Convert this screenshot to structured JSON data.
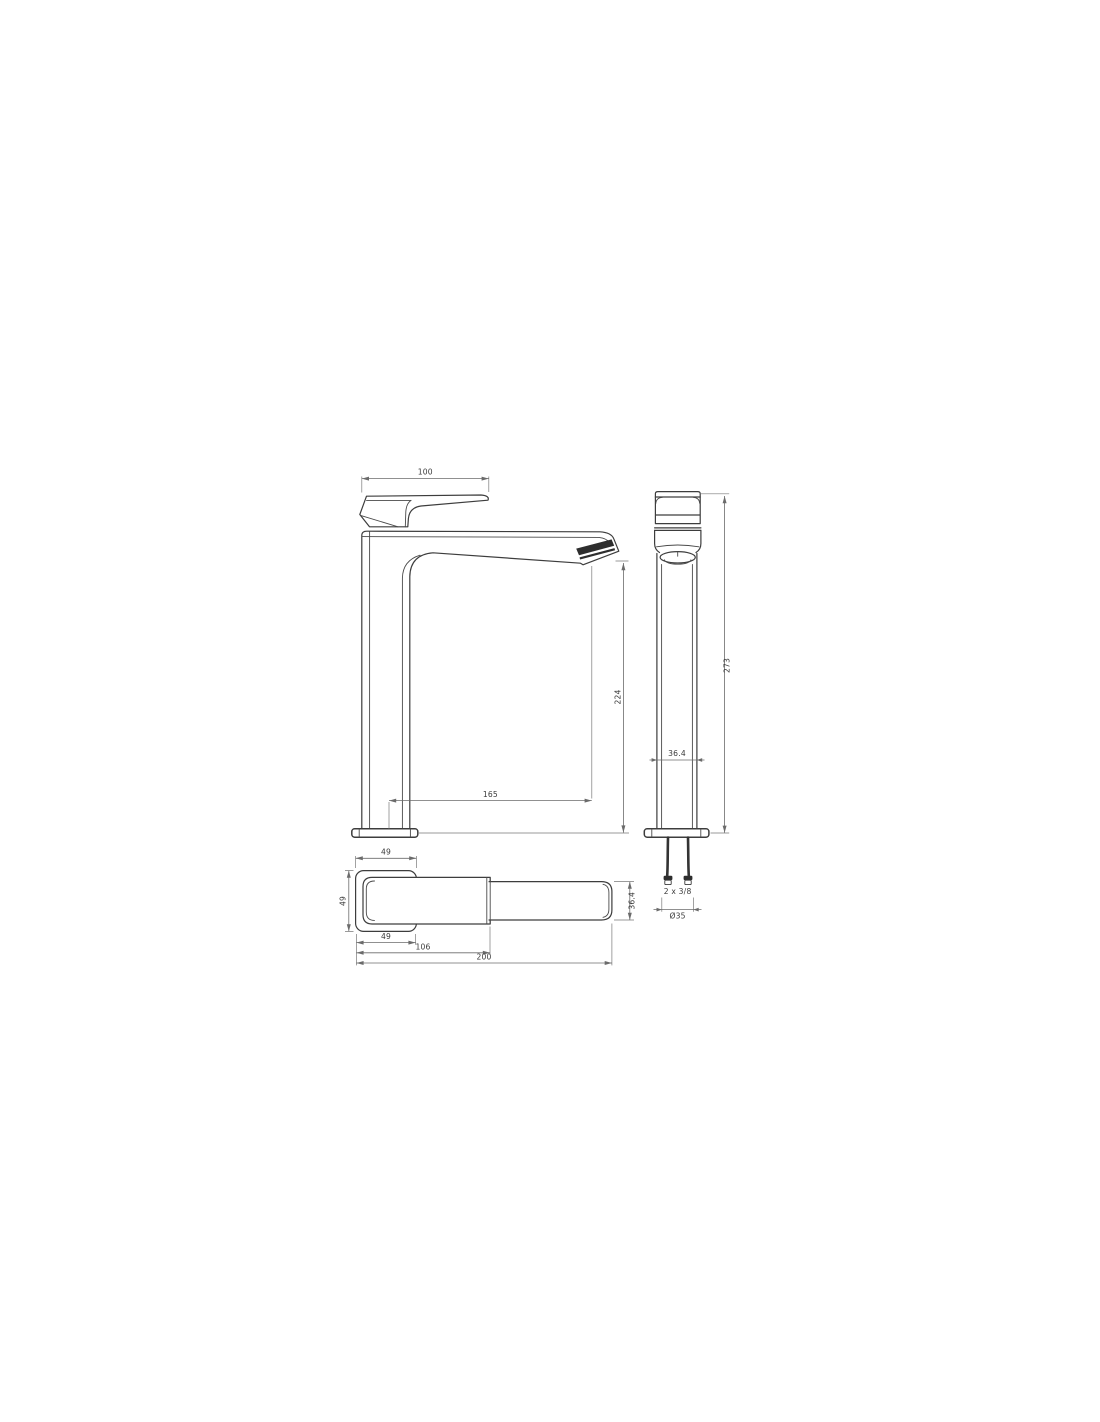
{
  "drawing": {
    "kind": "technical dimension drawing",
    "colors": {
      "background": "#ffffff",
      "line": "#3d3d3d",
      "dimension_line": "#6b6b6b",
      "text": "#3a3a3a",
      "accent_dark": "#2e2e2e"
    },
    "views": {
      "side": {
        "dims": {
          "handle_length": "100",
          "outlet_height": "224",
          "spout_reach": "165"
        }
      },
      "front": {
        "dims": {
          "total_height": "273",
          "body_width": "36.4",
          "hose_thread": "2 x 3/8",
          "mounting_diameter": "Ø35"
        }
      },
      "top": {
        "dims": {
          "base_width": "49",
          "base_depth": "49",
          "base_width_bottom": "49",
          "body_length": "106",
          "total_length": "200",
          "spout_width": "36.4"
        }
      }
    }
  }
}
